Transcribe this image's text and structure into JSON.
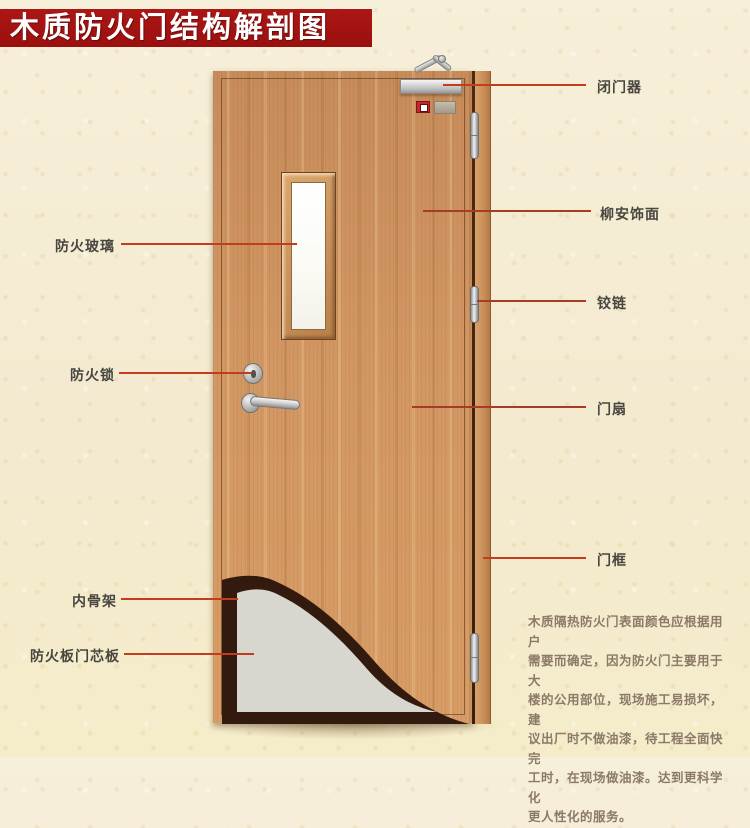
{
  "title": "木质防火门结构解剖图",
  "diagram": {
    "labels_left": [
      {
        "text": "防火玻璃"
      },
      {
        "text": "防火锁"
      },
      {
        "text": "内骨架"
      },
      {
        "text": "防火板门芯板"
      }
    ],
    "labels_right": [
      {
        "text": "闭门器"
      },
      {
        "text": "柳安饰面"
      },
      {
        "text": "铰链"
      },
      {
        "text": "门扇"
      },
      {
        "text": "门框"
      }
    ],
    "note": "木质隔热防火门表面颜色应根据用户\n需要而确定，因为防火门主要用于大\n楼的公用部位，现场施工易损坏，建\n议出厂时不做油漆，待工程全面快完\n工时，在现场做油漆。达到更科学化\n更人性化的服务。"
  },
  "colors": {
    "banner": "#a01312",
    "leader_line": "#c43b1e",
    "wood": "#cf9361",
    "core_board": "#d7d6cf",
    "skeleton": "#321b0e",
    "background": "#f4ebd0"
  }
}
